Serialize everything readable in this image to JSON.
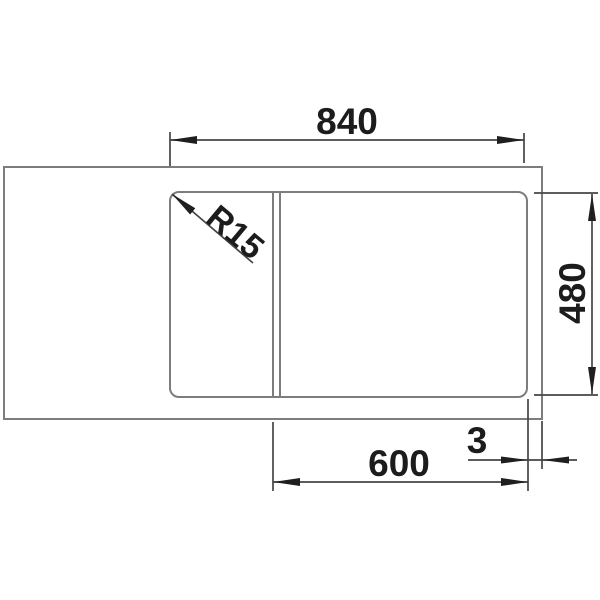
{
  "labels": {
    "width_top": "840",
    "depth_right": "480",
    "width_bottom": "600",
    "offset_right": "3",
    "corner_radius": "R15"
  },
  "colors": {
    "background": "#ffffff",
    "object_line": "#7d7d7d",
    "dimension_line": "#454545",
    "arrow": "#1f1f1f",
    "text": "#1c1c1c"
  }
}
